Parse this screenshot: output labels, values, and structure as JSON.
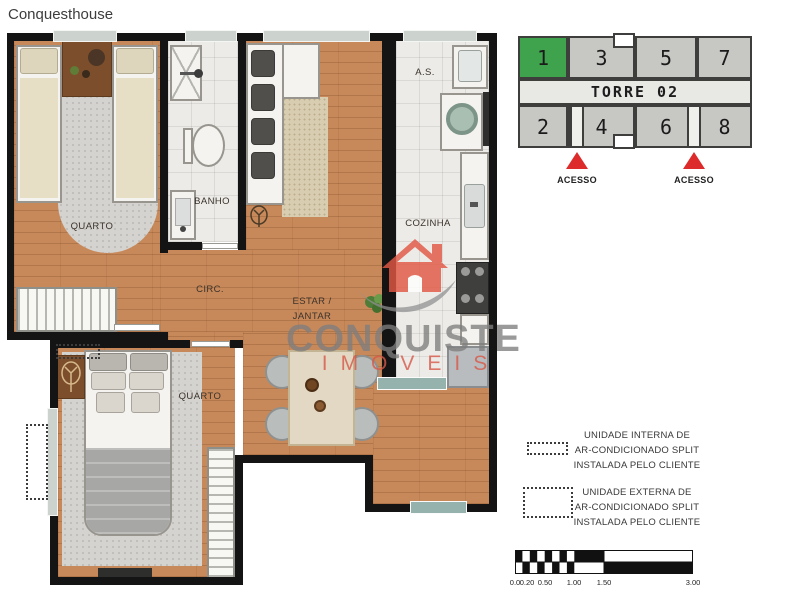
{
  "page": {
    "title": "Conquesthouse"
  },
  "floor_plan": {
    "rooms": {
      "bedroom1": "QUARTO",
      "bathroom": "BANHO",
      "circulation": "CIRC.",
      "living_line1": "ESTAR /",
      "living_line2": "JANTAR",
      "service_area": "A.S.",
      "kitchen": "COZINHA",
      "bedroom2": "QUARTO"
    }
  },
  "watermark": {
    "brand": "CONQUISTE",
    "subtitle": "IMOVEIS",
    "brand_color": "#7d7d7d",
    "subtitle_color": "#d75848",
    "house_color": "#e25845"
  },
  "tower": {
    "title": "TORRE 02",
    "top_units": [
      "1",
      "3",
      "5",
      "7"
    ],
    "bottom_units": [
      "2",
      "4",
      "6",
      "8"
    ],
    "highlighted_unit": "1",
    "unit_color": "#c7c7c4",
    "highlight_color": "#3fa24c",
    "access_label": "ACESSO",
    "arrow_color": "#dd2b2b"
  },
  "legend": {
    "internal_unit": {
      "line1": "UNIDADE INTERNA DE",
      "line2": "AR-CONDICIONADO SPLIT",
      "line3": "INSTALADA PELO CLIENTE"
    },
    "external_unit": {
      "line1": "UNIDADE EXTERNA DE",
      "line2": "AR-CONDICIONADO SPLIT",
      "line3": "INSTALADA PELO CLIENTE"
    }
  },
  "scale_bar": {
    "labels": [
      "0.0",
      "0.20",
      "0.50",
      "1.00",
      "1.50",
      "3.00"
    ]
  }
}
